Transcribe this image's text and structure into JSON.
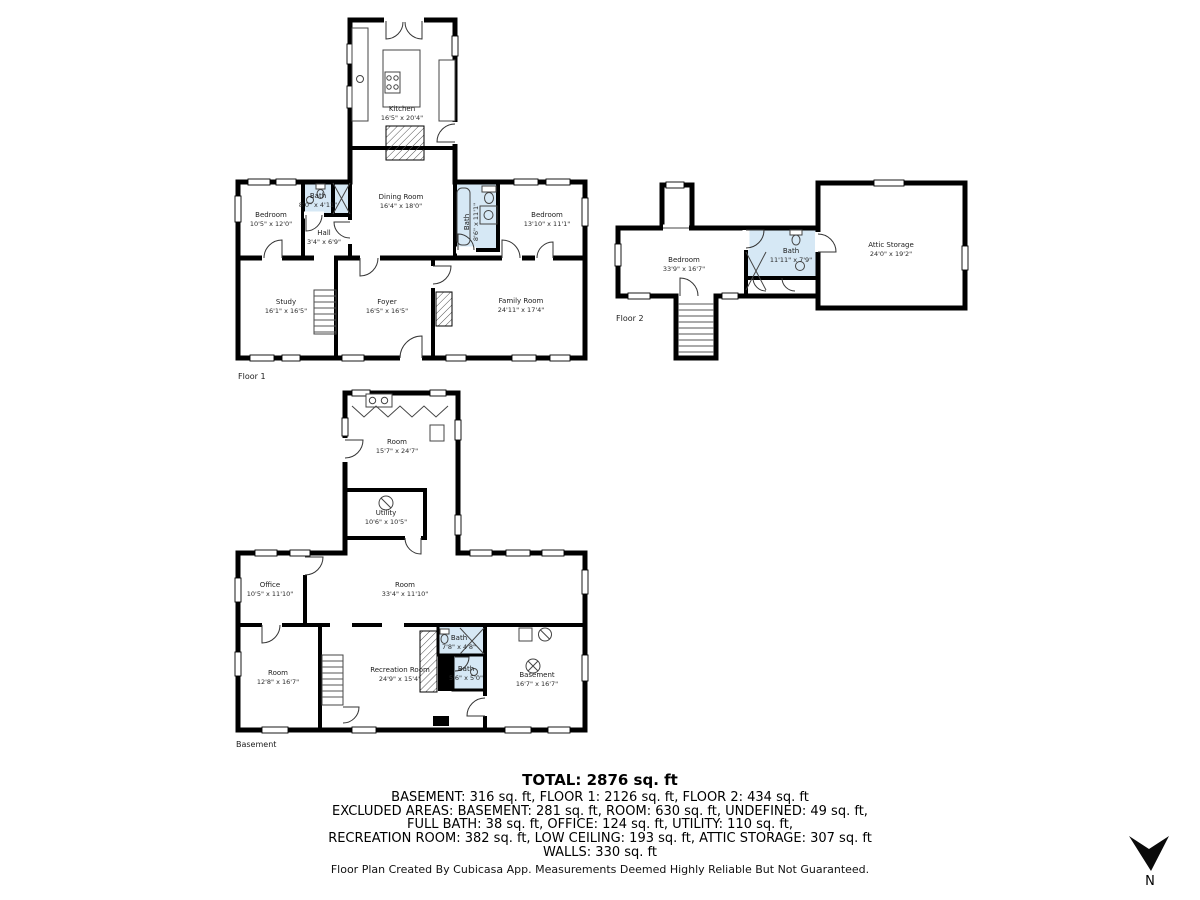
{
  "captions": {
    "floor1": "Floor 1",
    "floor2": "Floor 2",
    "basement": "Basement",
    "north": "N"
  },
  "colors": {
    "wall": "#000000",
    "bath_fill": "#d6e8f5"
  },
  "floor1": {
    "kitchen": {
      "name": "Kitchen",
      "dims": "16'5\" x 20'4\""
    },
    "bedroom_left": {
      "name": "Bedroom",
      "dims": "10'5\" x 12'0\""
    },
    "bath_left": {
      "name": "Bath",
      "dims": "8'0\" x 4'11\""
    },
    "hall": {
      "name": "Hall",
      "dims": "3'4\" x 6'9\""
    },
    "dining": {
      "name": "Dining Room",
      "dims": "16'4\" x 18'0\""
    },
    "bath_right": {
      "name": "Bath",
      "dims": "8'6\" x 11'1\""
    },
    "bedroom_right": {
      "name": "Bedroom",
      "dims": "13'10\" x 11'1\""
    },
    "study": {
      "name": "Study",
      "dims": "16'1\" x 16'5\""
    },
    "foyer": {
      "name": "Foyer",
      "dims": "16'5\" x 16'5\""
    },
    "family": {
      "name": "Family Room",
      "dims": "24'11\" x 17'4\""
    }
  },
  "floor2": {
    "bedroom": {
      "name": "Bedroom",
      "dims": "33'9\" x 16'7\""
    },
    "bath": {
      "name": "Bath",
      "dims": "11'11\" x 7'9\""
    },
    "attic": {
      "name": "Attic Storage",
      "dims": "24'0\" x 19'2\""
    }
  },
  "basement": {
    "room_top": {
      "name": "Room",
      "dims": "15'7\" x 24'7\""
    },
    "utility": {
      "name": "Utility",
      "dims": "10'6\" x 10'5\""
    },
    "office": {
      "name": "Office",
      "dims": "10'5\" x 11'10\""
    },
    "room_mid": {
      "name": "Room",
      "dims": "33'4\" x 11'10\""
    },
    "room_left": {
      "name": "Room",
      "dims": "12'8\" x 16'7\""
    },
    "recreation": {
      "name": "Recreation Room",
      "dims": "24'9\" x 15'4\""
    },
    "bath_top": {
      "name": "Bath",
      "dims": "7'8\" x 4'8\""
    },
    "bath_lower": {
      "name": "Bath",
      "dims": "5'6\" x 5'0\""
    },
    "basement_room": {
      "name": "Basement",
      "dims": "16'7\" x 16'7\""
    }
  },
  "summary": {
    "total": "TOTAL: 2876 sq. ft",
    "line1": "BASEMENT: 316 sq. ft, FLOOR 1: 2126 sq. ft, FLOOR 2: 434 sq. ft",
    "line2": "EXCLUDED AREAS: BASEMENT: 281 sq. ft, ROOM: 630 sq. ft, UNDEFINED: 49 sq. ft,",
    "line3": "FULL BATH: 38 sq. ft, OFFICE: 124 sq. ft, UTILITY: 110 sq. ft,",
    "line4": "RECREATION ROOM: 382 sq. ft, LOW CEILING: 193 sq. ft, ATTIC STORAGE: 307 sq. ft",
    "line5": "WALLS: 330 sq. ft"
  },
  "footer": "Floor Plan Created By Cubicasa App. Measurements Deemed Highly Reliable But Not Guaranteed."
}
